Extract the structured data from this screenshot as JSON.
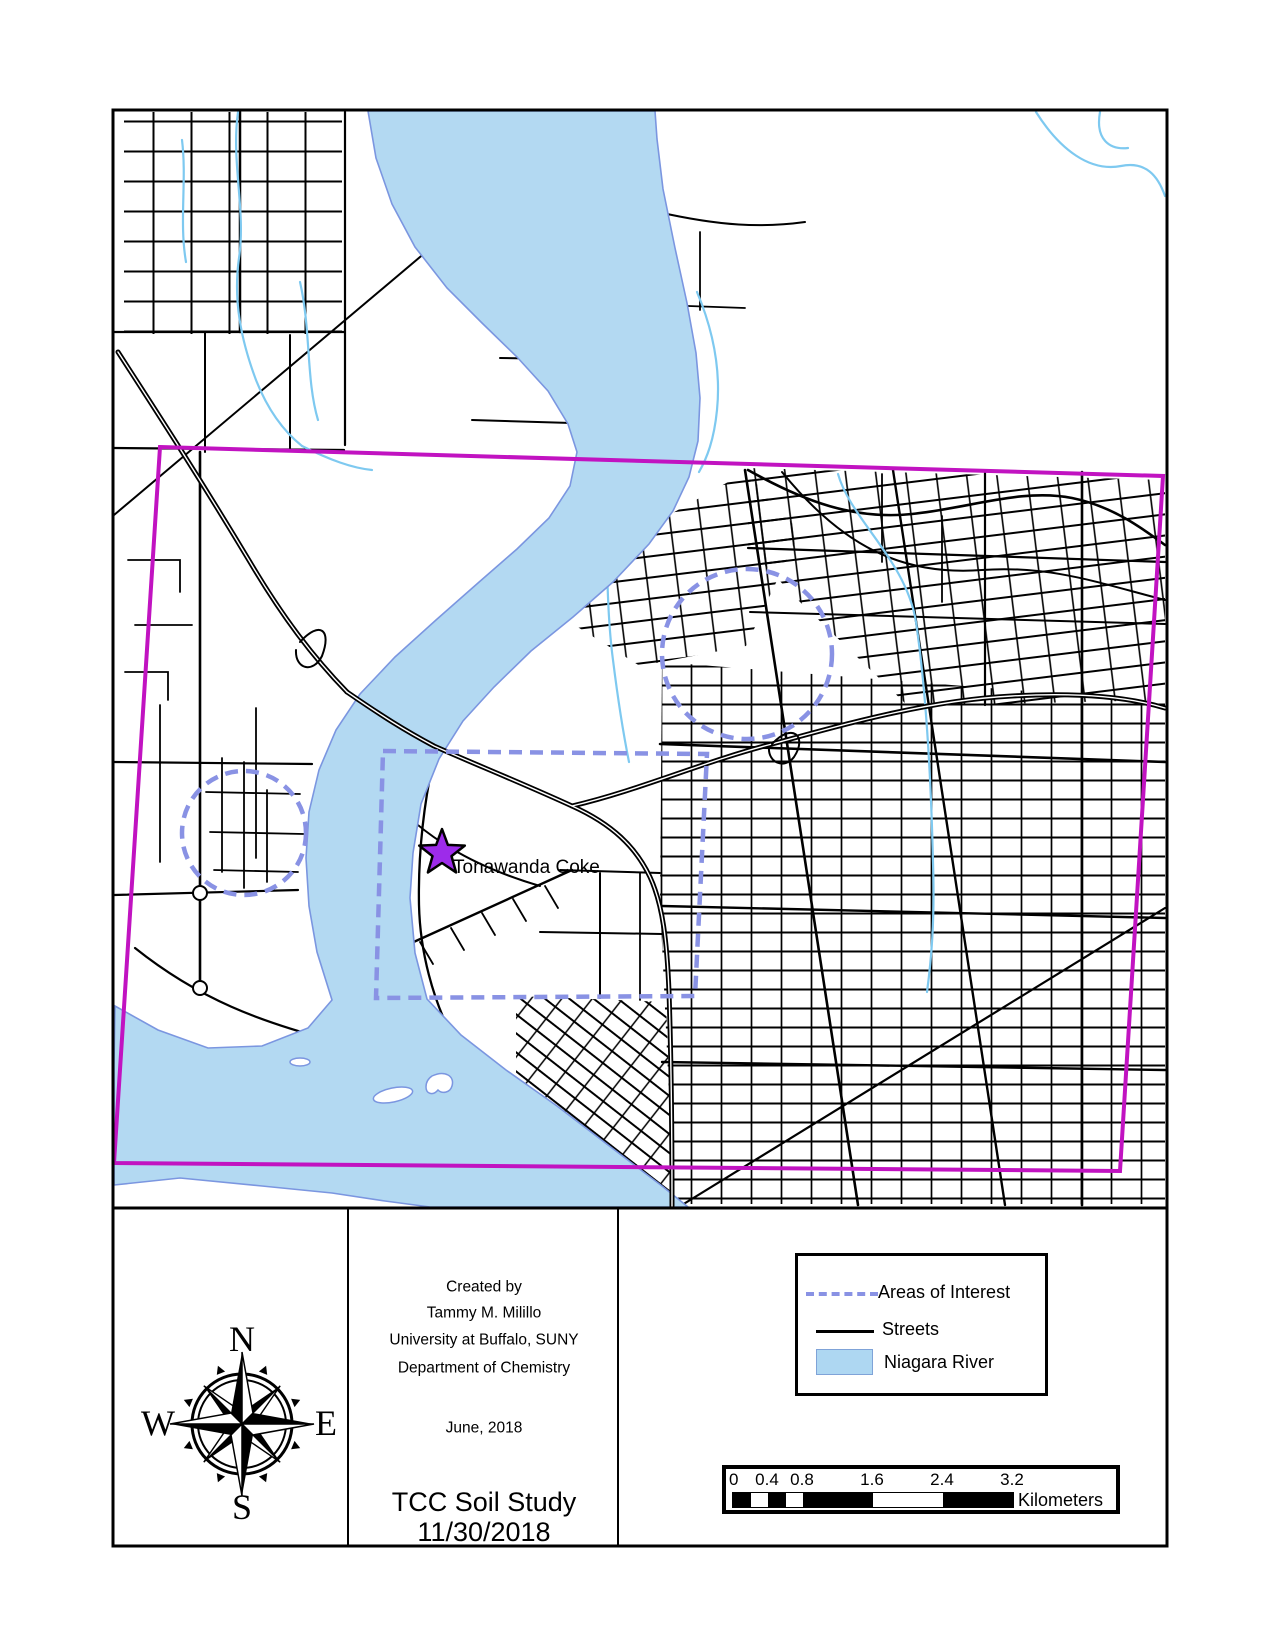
{
  "map": {
    "star_label": "Tonawanda Coke",
    "colors": {
      "river_fill": "#b3d9f2",
      "river_edge": "#7b96e0",
      "boundary": "#c113c1",
      "aoi_dash": "#8992e4",
      "star_fill": "#9d2bea",
      "street": "#000000",
      "creek": "#7ec9f0"
    }
  },
  "info": {
    "lines": [
      "Created by",
      "Tammy M. Milillo",
      "University at Buffalo, SUNY",
      "Department of Chemistry"
    ],
    "date_line": "June, 2018",
    "title": "TCC Soil Study",
    "title_date": "11/30/2018"
  },
  "compass": {
    "north": "N",
    "south": "S",
    "east": "E",
    "west": "W"
  },
  "legend": {
    "items": [
      {
        "label": "Areas of Interest",
        "swatch": "dashed-line"
      },
      {
        "label": "Streets",
        "swatch": "solid-line"
      },
      {
        "label": "Niagara River",
        "swatch": "blue-fill"
      }
    ]
  },
  "scalebar": {
    "ticks": [
      "0",
      "0.4",
      "0.8",
      "1.6",
      "2.4",
      "3.2"
    ],
    "unit": "Kilometers"
  }
}
